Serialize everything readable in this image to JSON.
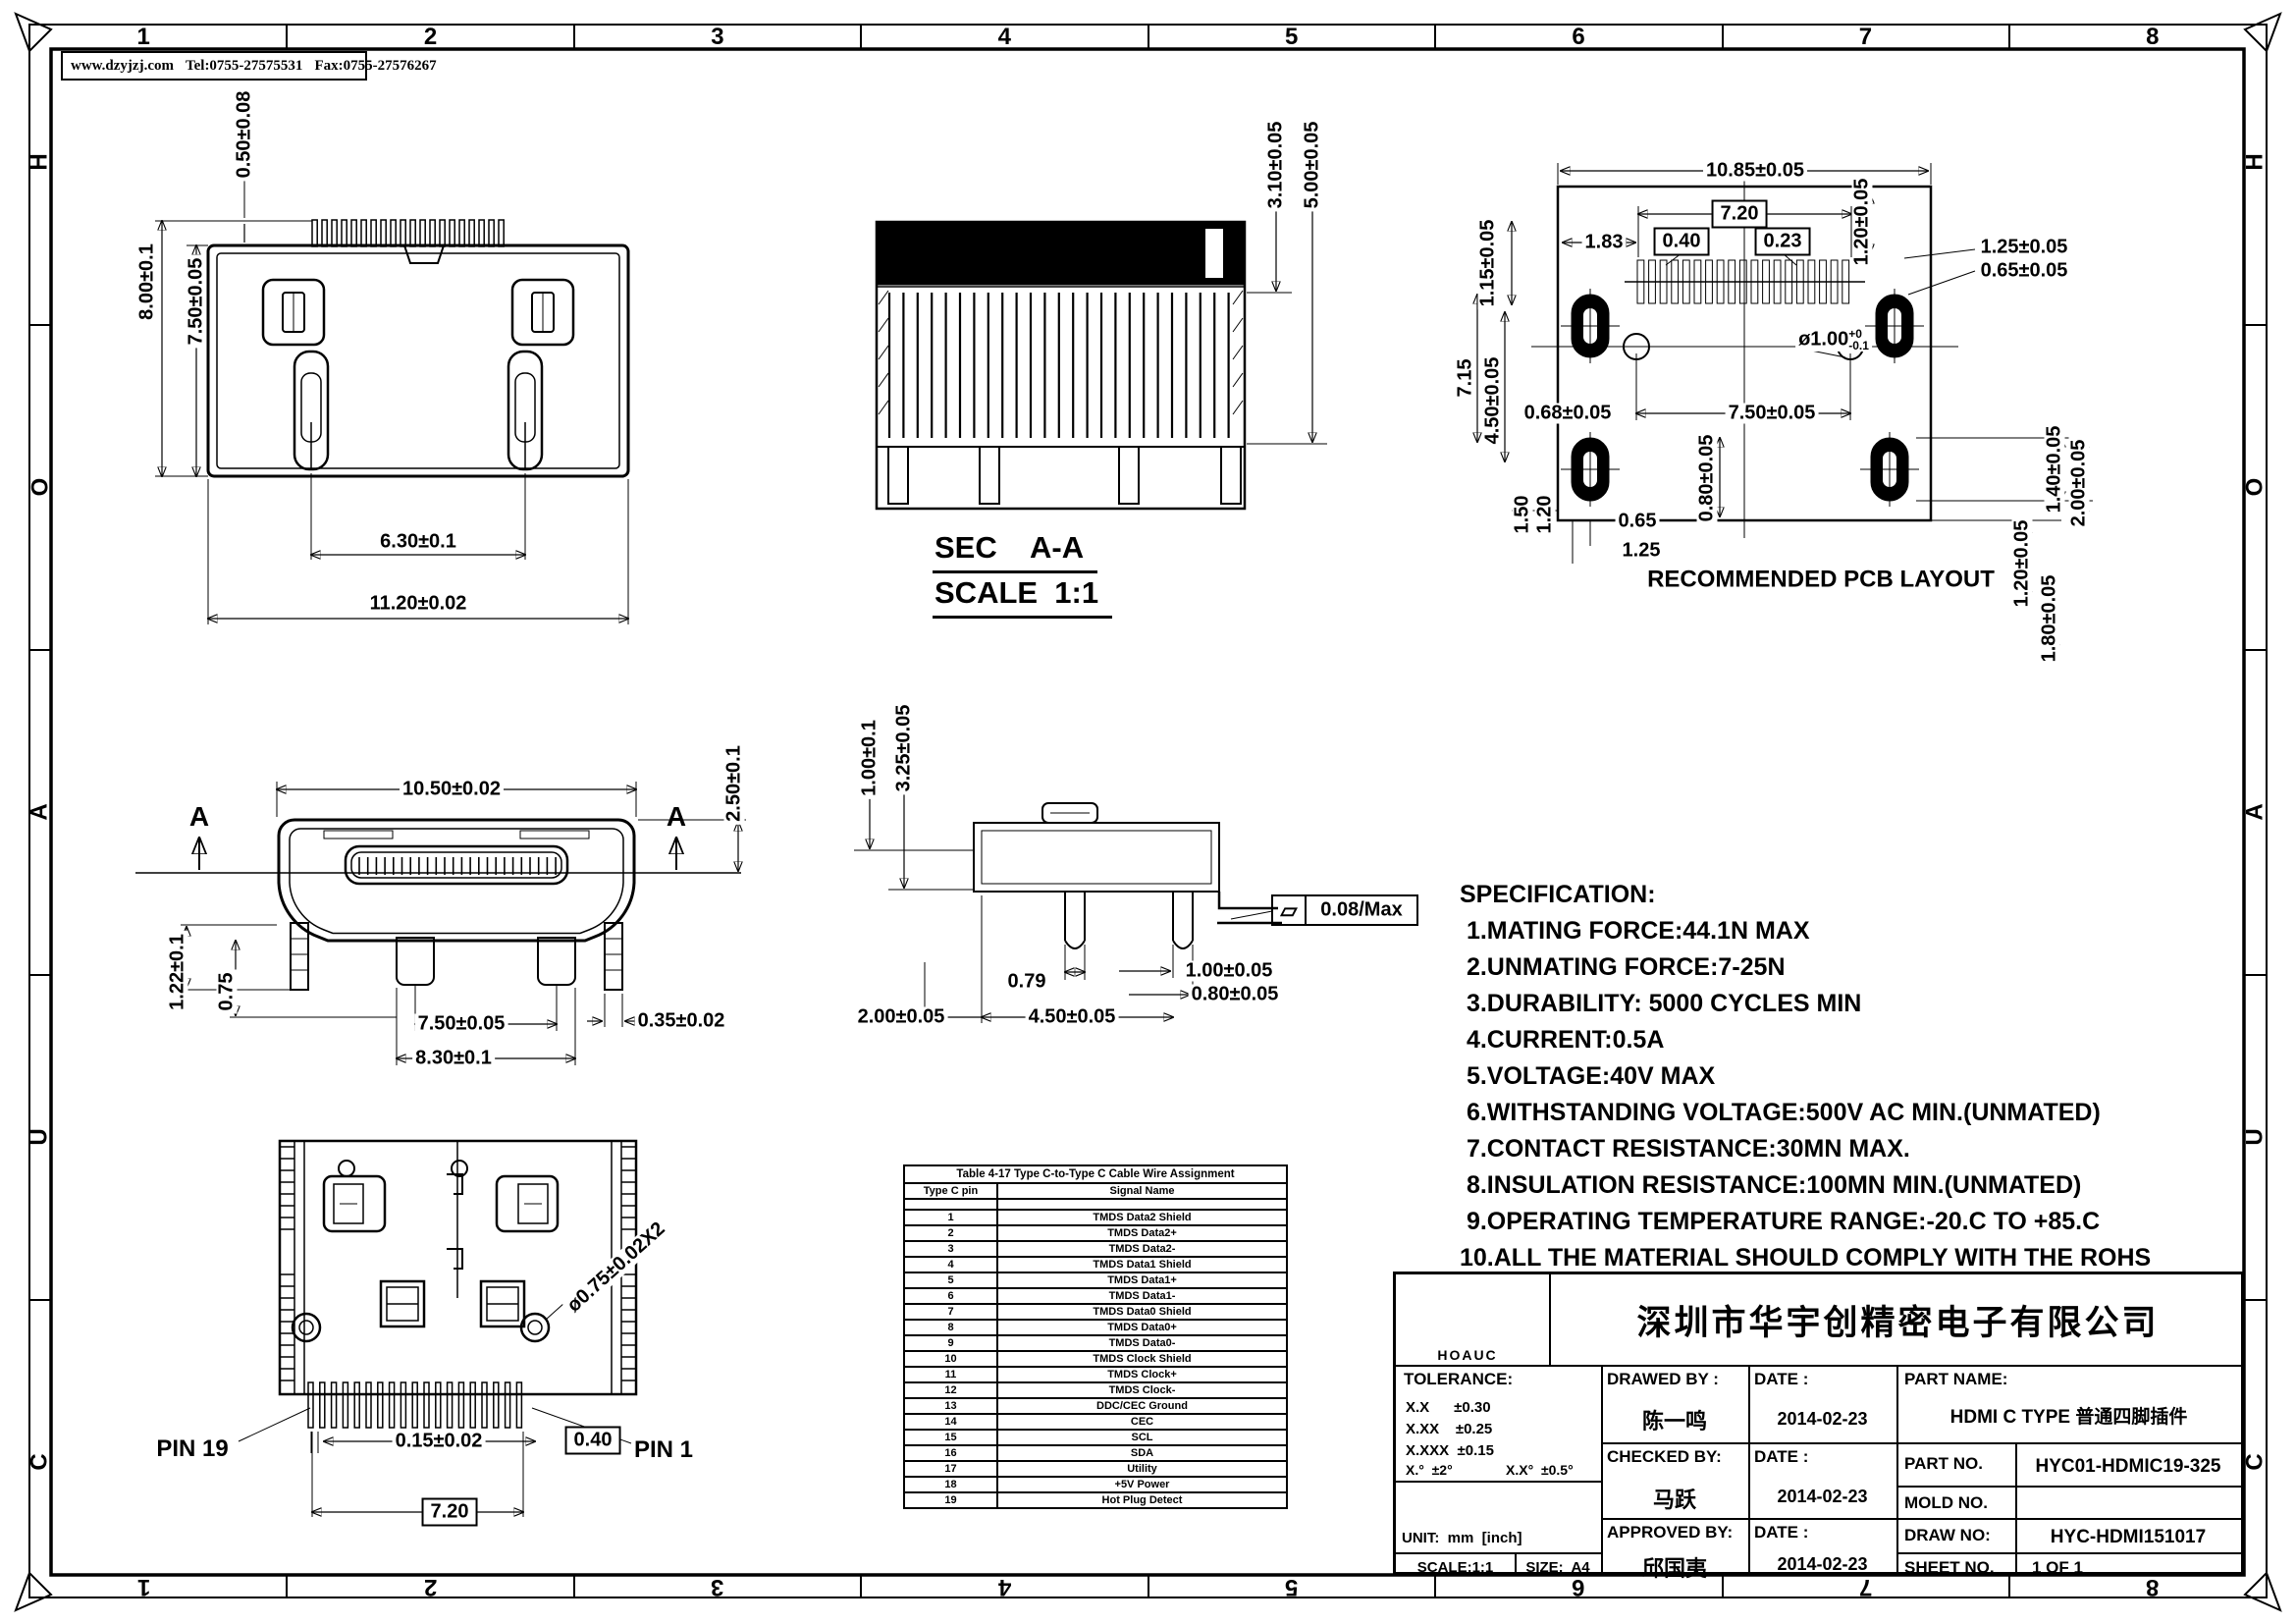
{
  "header": {
    "website": "www.dzyjzj.com",
    "tel": "Tel:0755-27575531",
    "fax": "Fax:0755-27576267"
  },
  "zones": {
    "cols": [
      "1",
      "2",
      "3",
      "4",
      "5",
      "6",
      "7",
      "8"
    ],
    "rows": [
      "H",
      "O",
      "A",
      "U",
      "C"
    ]
  },
  "view_top": {
    "dims": {
      "d050": "0.50±0.08",
      "d800": "8.00±0.1",
      "d750": "7.50±0.05",
      "d630": "6.30±0.1",
      "d1120": "11.20±0.02"
    }
  },
  "sec_aa": {
    "title": "SEC    A-A",
    "scale": "SCALE  1:1",
    "dims": {
      "d310": "3.10±0.05",
      "d500": "5.00±0.05"
    }
  },
  "pcb": {
    "caption": "RECOMMENDED PCB LAYOUT",
    "dims": {
      "d1085": "10.85±0.05",
      "d720": "7.20",
      "d183": "1.83",
      "d040": "0.40",
      "d023": "0.23",
      "d120top": "1.20±0.05",
      "d115": "1.15±0.05",
      "d125r": "1.25±0.05",
      "d065r": "0.65±0.05",
      "dia": "ø1.00",
      "dia_sup": "+0",
      "dia_sub": "-0.1",
      "d750": "7.50±0.05",
      "d715": "7.15",
      "d450": "4.50±0.05",
      "d068": "0.68±0.05",
      "d080": "0.80±0.05",
      "d150": "1.50",
      "d120l": "1.20",
      "d065b": "0.65",
      "d125b": "1.25",
      "d140": "1.40±0.05",
      "d200": "2.00±0.05",
      "d120br": "1.20±0.05",
      "d180": "1.80±0.05"
    }
  },
  "view_front": {
    "section_mark": "A",
    "dims": {
      "d1050": "10.50±0.02",
      "d250": "2.50±0.1",
      "d122": "1.22±0.1",
      "d075": "0.75",
      "d750": "7.50±0.05",
      "d830": "8.30±0.1",
      "d035": "0.35±0.02"
    }
  },
  "view_side": {
    "flatness_symbol": "▱",
    "flatness_value": "0.08/Max",
    "dims": {
      "d100": "1.00±0.1",
      "d325": "3.25±0.05",
      "d079": "0.79",
      "d100b": "1.00±0.05",
      "d080": "0.80±0.05",
      "d450": "4.50±0.05",
      "d200": "2.00±0.05"
    }
  },
  "view_bottom": {
    "pin19": "PIN 19",
    "pin1": "PIN 1",
    "dims": {
      "d015": "0.15±0.02",
      "d040": "0.40",
      "d720": "7.20",
      "d075x2": "ø0.75±0.02X2"
    }
  },
  "spec": {
    "title": "SPECIFICATION:",
    "items": [
      " 1.MATING FORCE:44.1N MAX",
      " 2.UNMATING FORCE:7-25N",
      " 3.DURABILITY: 5000 CYCLES MIN",
      " 4.CURRENT:0.5A",
      " 5.VOLTAGE:40V MAX",
      " 6.WITHSTANDING VOLTAGE:500V AC MIN.(UNMATED)",
      " 7.CONTACT RESISTANCE:30MN MAX.",
      " 8.INSULATION RESISTANCE:100MN MIN.(UNMATED)",
      " 9.OPERATING TEMPERATURE RANGE:-20.C TO +85.C",
      "10.ALL THE MATERIAL SHOULD COMPLY WITH THE ROHS",
      "        REQUIREMENT."
    ]
  },
  "wire_table": {
    "title": "Table 4-17 Type C-to-Type C Cable Wire Assignment",
    "col_pin": "Type C pin",
    "col_signal": "Signal Name",
    "rows": [
      {
        "pin": "1",
        "signal": "TMDS Data2 Shield"
      },
      {
        "pin": "2",
        "signal": "TMDS Data2+"
      },
      {
        "pin": "3",
        "signal": "TMDS Data2-"
      },
      {
        "pin": "4",
        "signal": "TMDS Data1 Shield"
      },
      {
        "pin": "5",
        "signal": "TMDS Data1+"
      },
      {
        "pin": "6",
        "signal": "TMDS Data1-"
      },
      {
        "pin": "7",
        "signal": "TMDS Data0 Shield"
      },
      {
        "pin": "8",
        "signal": "TMDS Data0+"
      },
      {
        "pin": "9",
        "signal": "TMDS Data0-"
      },
      {
        "pin": "10",
        "signal": "TMDS Clock Shield"
      },
      {
        "pin": "11",
        "signal": "TMDS Clock+"
      },
      {
        "pin": "12",
        "signal": "TMDS Clock-"
      },
      {
        "pin": "13",
        "signal": "DDC/CEC Ground"
      },
      {
        "pin": "14",
        "signal": "CEC"
      },
      {
        "pin": "15",
        "signal": "SCL"
      },
      {
        "pin": "16",
        "signal": "SDA"
      },
      {
        "pin": "17",
        "signal": "Utility"
      },
      {
        "pin": "18",
        "signal": "+5V Power"
      },
      {
        "pin": "19",
        "signal": "Hot Plug Detect"
      }
    ]
  },
  "titleblock": {
    "brand": "HOAUC",
    "company": "深圳市华宇创精密电子有限公司",
    "tolerance": {
      "title": "TOLERANCE:",
      "r1": "X.X      ±0.30",
      "r2": "X.XX    ±0.25",
      "r3": "X.XXX  ±0.15",
      "r4": "X.°  ±2°",
      "r5": "X.X°  ±0.5°"
    },
    "drawed_label": "DRAWED BY :",
    "date_label": "DATE :",
    "drawed_by": "陈一鸣",
    "drawed_date": "2014-02-23",
    "checked_label": "CHECKED BY:",
    "checked_by": "马跃",
    "checked_date": "2014-02-23",
    "approved_label": "APPROVED BY:",
    "approved_by": "邱国夷",
    "approved_date": "2014-02-23",
    "part_name_label": "PART NAME:",
    "part_name": "HDMI C TYPE 普通四脚插件",
    "part_no_label": "PART NO.",
    "part_no": "HYC01-HDMIC19-325",
    "mold_no_label": "MOLD NO.",
    "draw_no_label": "DRAW NO:",
    "draw_no": "HYC-HDMI151017",
    "sheet_no_label": "SHEET NO.",
    "sheet_no": "1 OF 1",
    "unit": "UNIT:  mm  [inch]",
    "scale": "SCALE:1:1",
    "size": "SIZE:  A4"
  }
}
